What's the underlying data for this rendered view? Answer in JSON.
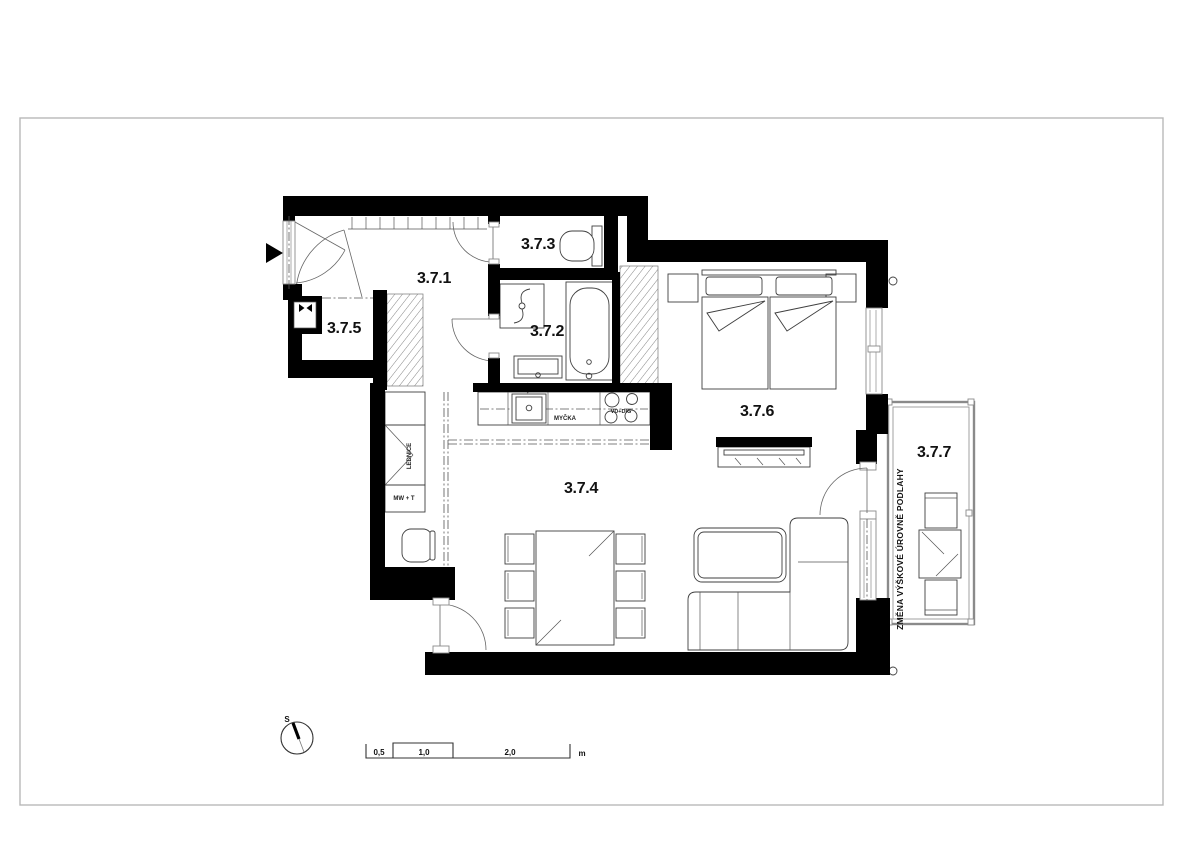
{
  "drawing": {
    "type": "apartment-floor-plan"
  },
  "rooms": {
    "r1": {
      "label": "3.7.1"
    },
    "r2": {
      "label": "3.7.2"
    },
    "r3": {
      "label": "3.7.3"
    },
    "r4": {
      "label": "3.7.4"
    },
    "r5": {
      "label": "3.7.5"
    },
    "r6": {
      "label": "3.7.6"
    },
    "r7": {
      "label": "3.7.7"
    }
  },
  "annotations": {
    "floor_level_note": "ZMĚNA VÝŠKOVÉ ÚROVNĚ PODLAHY",
    "dishwasher": "MYČKA",
    "hob": "VD+DIG",
    "fridge": "LEDNICE",
    "microwave_toaster": "MW + T"
  },
  "compass": {
    "north_label": "S"
  },
  "scale_bar": {
    "tick1": "0,5",
    "tick2": "1,0",
    "tick3": "2,0",
    "unit": "m"
  },
  "colors": {
    "wall": "#000000",
    "furniture_line": "#3f3f3f",
    "page_frame": "#b8b8b8",
    "background": "#ffffff"
  }
}
